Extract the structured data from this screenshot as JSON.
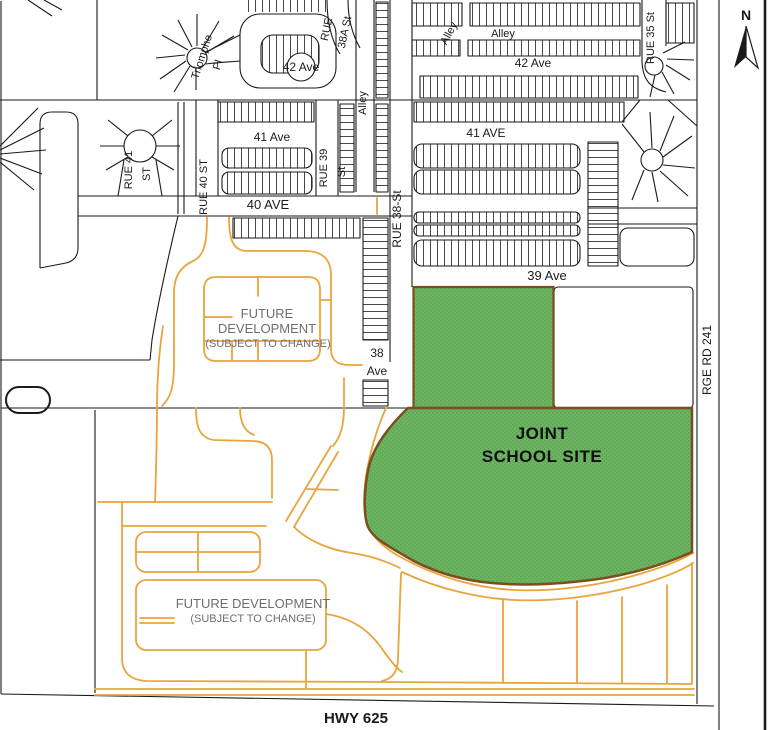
{
  "north_indicator": "N",
  "streets": {
    "triomphe_line1": "Triomphe",
    "triomphe_line2": "Pl",
    "ave42_west": "42 Ave",
    "ave42_east": "42 Ave",
    "rue38a_line1": "RUE",
    "rue38a_line2": "38A St",
    "alley_diagonal": "Alley",
    "alley_horizontal": "Alley",
    "alley_vertical": "Alley",
    "ave41_west": "41 Ave",
    "ave41_east": "41 AVE",
    "rue41_line1": "RUE 41",
    "rue41_line2": "ST",
    "rue40": "RUE 40 ST",
    "rue39_line1": "RUE 39",
    "rue39_line2": "St",
    "ave40": "40 AVE",
    "rue38": "RUE 38-St",
    "rue35": "RUE 35 St",
    "ave39": "39 Ave",
    "ave38_line1": "38",
    "ave38_line2": "Ave",
    "rge_rd_241": "RGE RD 241",
    "hwy_625": "HWY 625"
  },
  "zones": {
    "school_site_line1": "JOINT",
    "school_site_line2": "SCHOOL SITE",
    "future_dev_north_line1": "FUTURE",
    "future_dev_north_line2": "DEVELOPMENT",
    "future_dev_north_line3": "(SUBJECT TO CHANGE)",
    "future_dev_south_line1": "FUTURE DEVELOPMENT",
    "future_dev_south_line2": "(SUBJECT TO CHANGE)"
  },
  "colors": {
    "school_site_fill": "#6DB463",
    "school_site_texture": "#58A04E",
    "school_site_border": "#7A4F1D",
    "future_road": "#E8A53C",
    "existing_road": "#1A1A1A",
    "zone_label": "#6E6E6E"
  }
}
